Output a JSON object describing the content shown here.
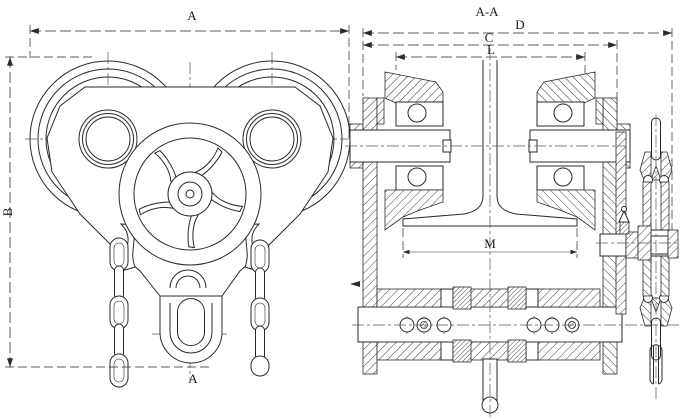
{
  "drawing": {
    "section_title": "A-A",
    "labels": {
      "dim_a": "A",
      "dim_b": "B",
      "section_mark": "A",
      "dim_d": "D",
      "dim_c": "C",
      "dim_l": "L",
      "dim_m": "M"
    },
    "colors": {
      "background": "#ffffff",
      "line": "#2a2a2a",
      "centerline": "#5a5a5a"
    }
  }
}
